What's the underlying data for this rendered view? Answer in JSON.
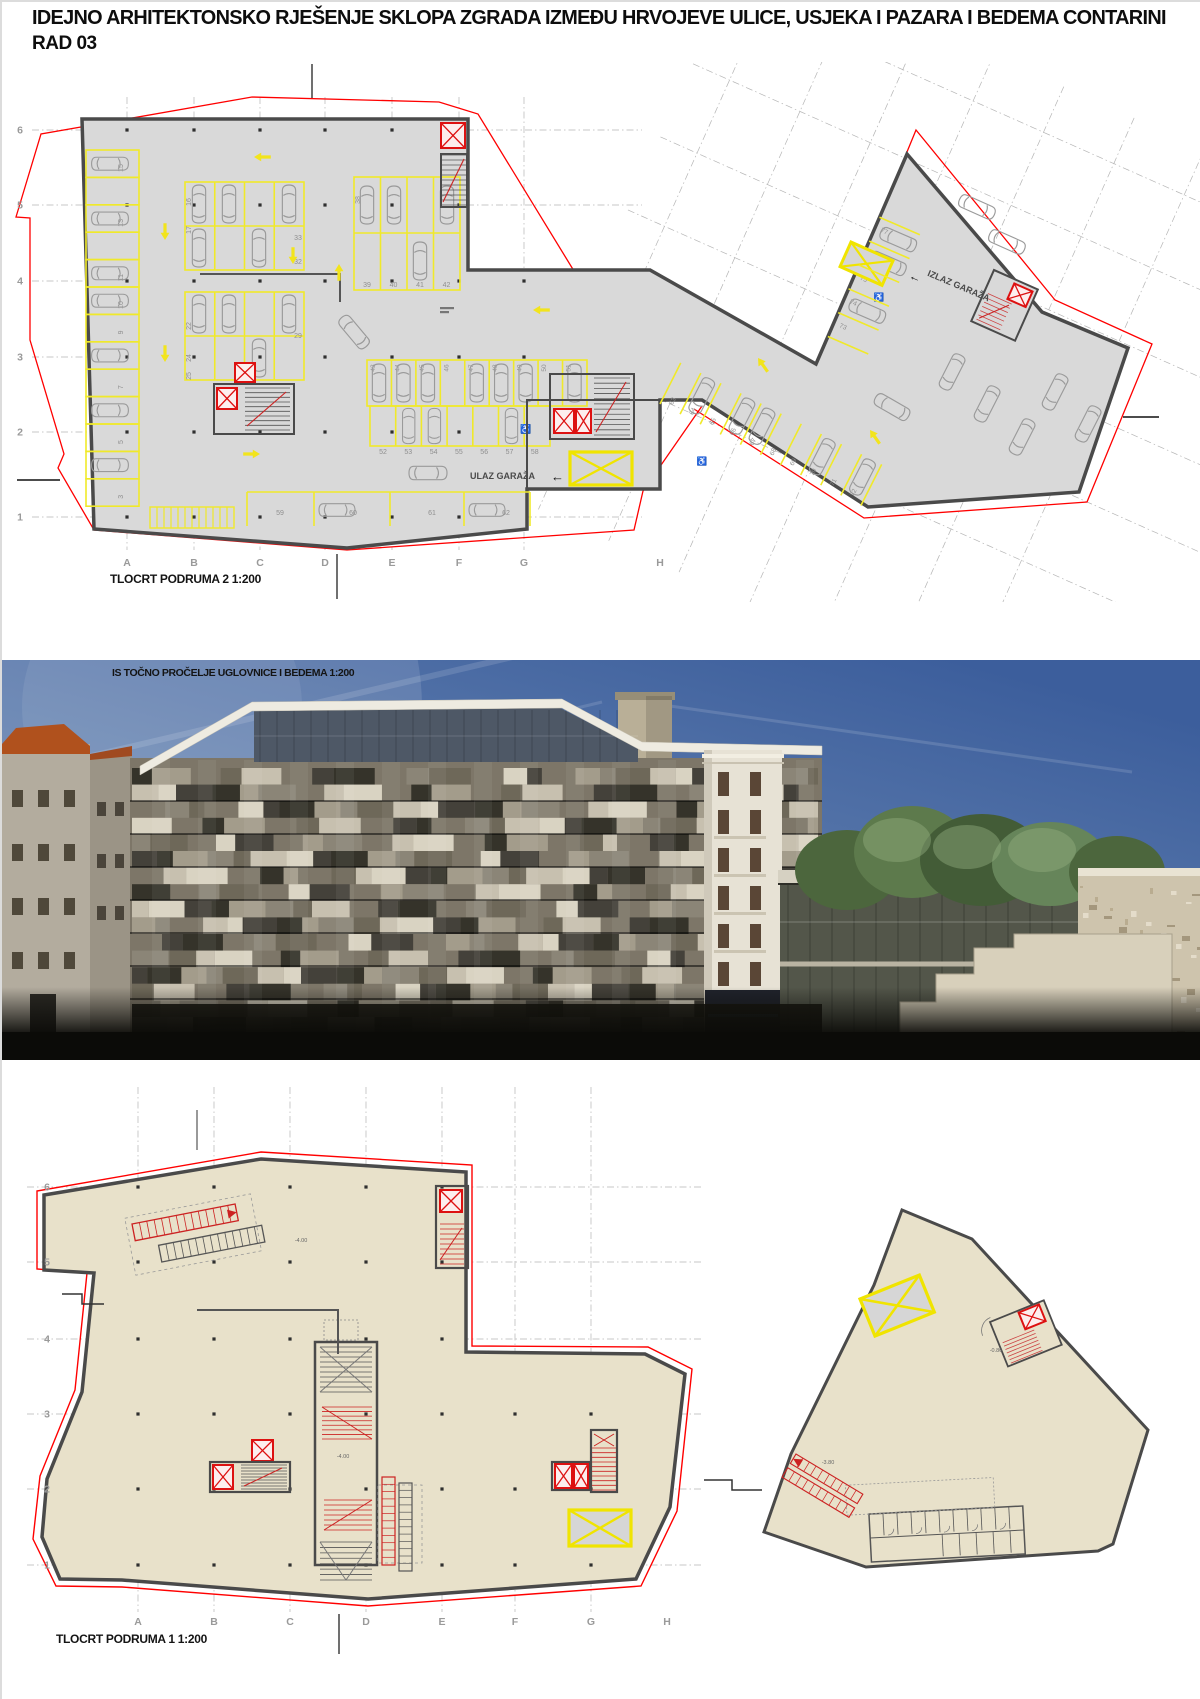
{
  "title": {
    "line1": "IDEJNO ARHITEKTONSKO RJEŠENJE SKLOPA ZGRADA IZMEĐU HRVOJEVE ULICE, USJEKA I PAZARA I BEDEMA CONTARINI",
    "line2": "RAD 03"
  },
  "render": {
    "caption": "IS TOČNO PROČELJE UGLOVNICE I BEDEMA 1:200"
  },
  "plan2": {
    "caption": "TLOCRT PODRUMA 2 1:200",
    "entrance_label": "ULAZ GARAŽA",
    "exit_label": "IZLAZ GARAŽA",
    "arrow_glyph": "←",
    "accessible_icon": "♿",
    "cols": [
      "A",
      "B",
      "C",
      "D",
      "E",
      "F",
      "G",
      "H"
    ],
    "rows": [
      "6",
      "5",
      "4",
      "3",
      "2",
      "1"
    ],
    "bays": {
      "left": [
        "15",
        "14",
        "13",
        "12",
        "11",
        "10",
        "9",
        "8",
        "7",
        "6",
        "5",
        "4",
        "3"
      ],
      "b_west": [
        "16",
        "17",
        "22",
        "24",
        "25"
      ],
      "b_east": [
        "33",
        "32",
        "29"
      ],
      "m_top": [
        "38"
      ],
      "m_bottom": [
        "39",
        "40",
        "41",
        "42"
      ],
      "c_top": [
        "43",
        "44",
        "45",
        "46",
        "47",
        "48",
        "49",
        "50",
        "51"
      ],
      "c_mid": [
        "52",
        "53",
        "54",
        "55",
        "56",
        "57",
        "58"
      ],
      "bottom": [
        "59",
        "60",
        "61",
        "62"
      ],
      "right_south": [
        "63",
        "64",
        "65",
        "66",
        "67",
        "68",
        "69",
        "70",
        "71",
        "72"
      ],
      "right_west": [
        "73",
        "74",
        "75",
        "76",
        "77"
      ]
    }
  },
  "plan1": {
    "caption": "TLOCRT PODRUMA 1 1:200",
    "cols": [
      "A",
      "B",
      "C",
      "D",
      "E",
      "F",
      "G",
      "H"
    ],
    "rows": [
      "6",
      "5",
      "4",
      "3",
      "2",
      "1"
    ],
    "levels": [
      "-4.00",
      "-4.00",
      "-3.80",
      "-0.80"
    ]
  },
  "colors": {
    "boundary_red": "#ff0000",
    "elevator_red": "#dd1111",
    "parking_yellow": "#f0e92a",
    "floor_gray": "#d9d9d9",
    "floor_beige": "#e8e1ca",
    "wall_gray": "#4a4a4a",
    "sky_blue": "#3c5e9c"
  }
}
